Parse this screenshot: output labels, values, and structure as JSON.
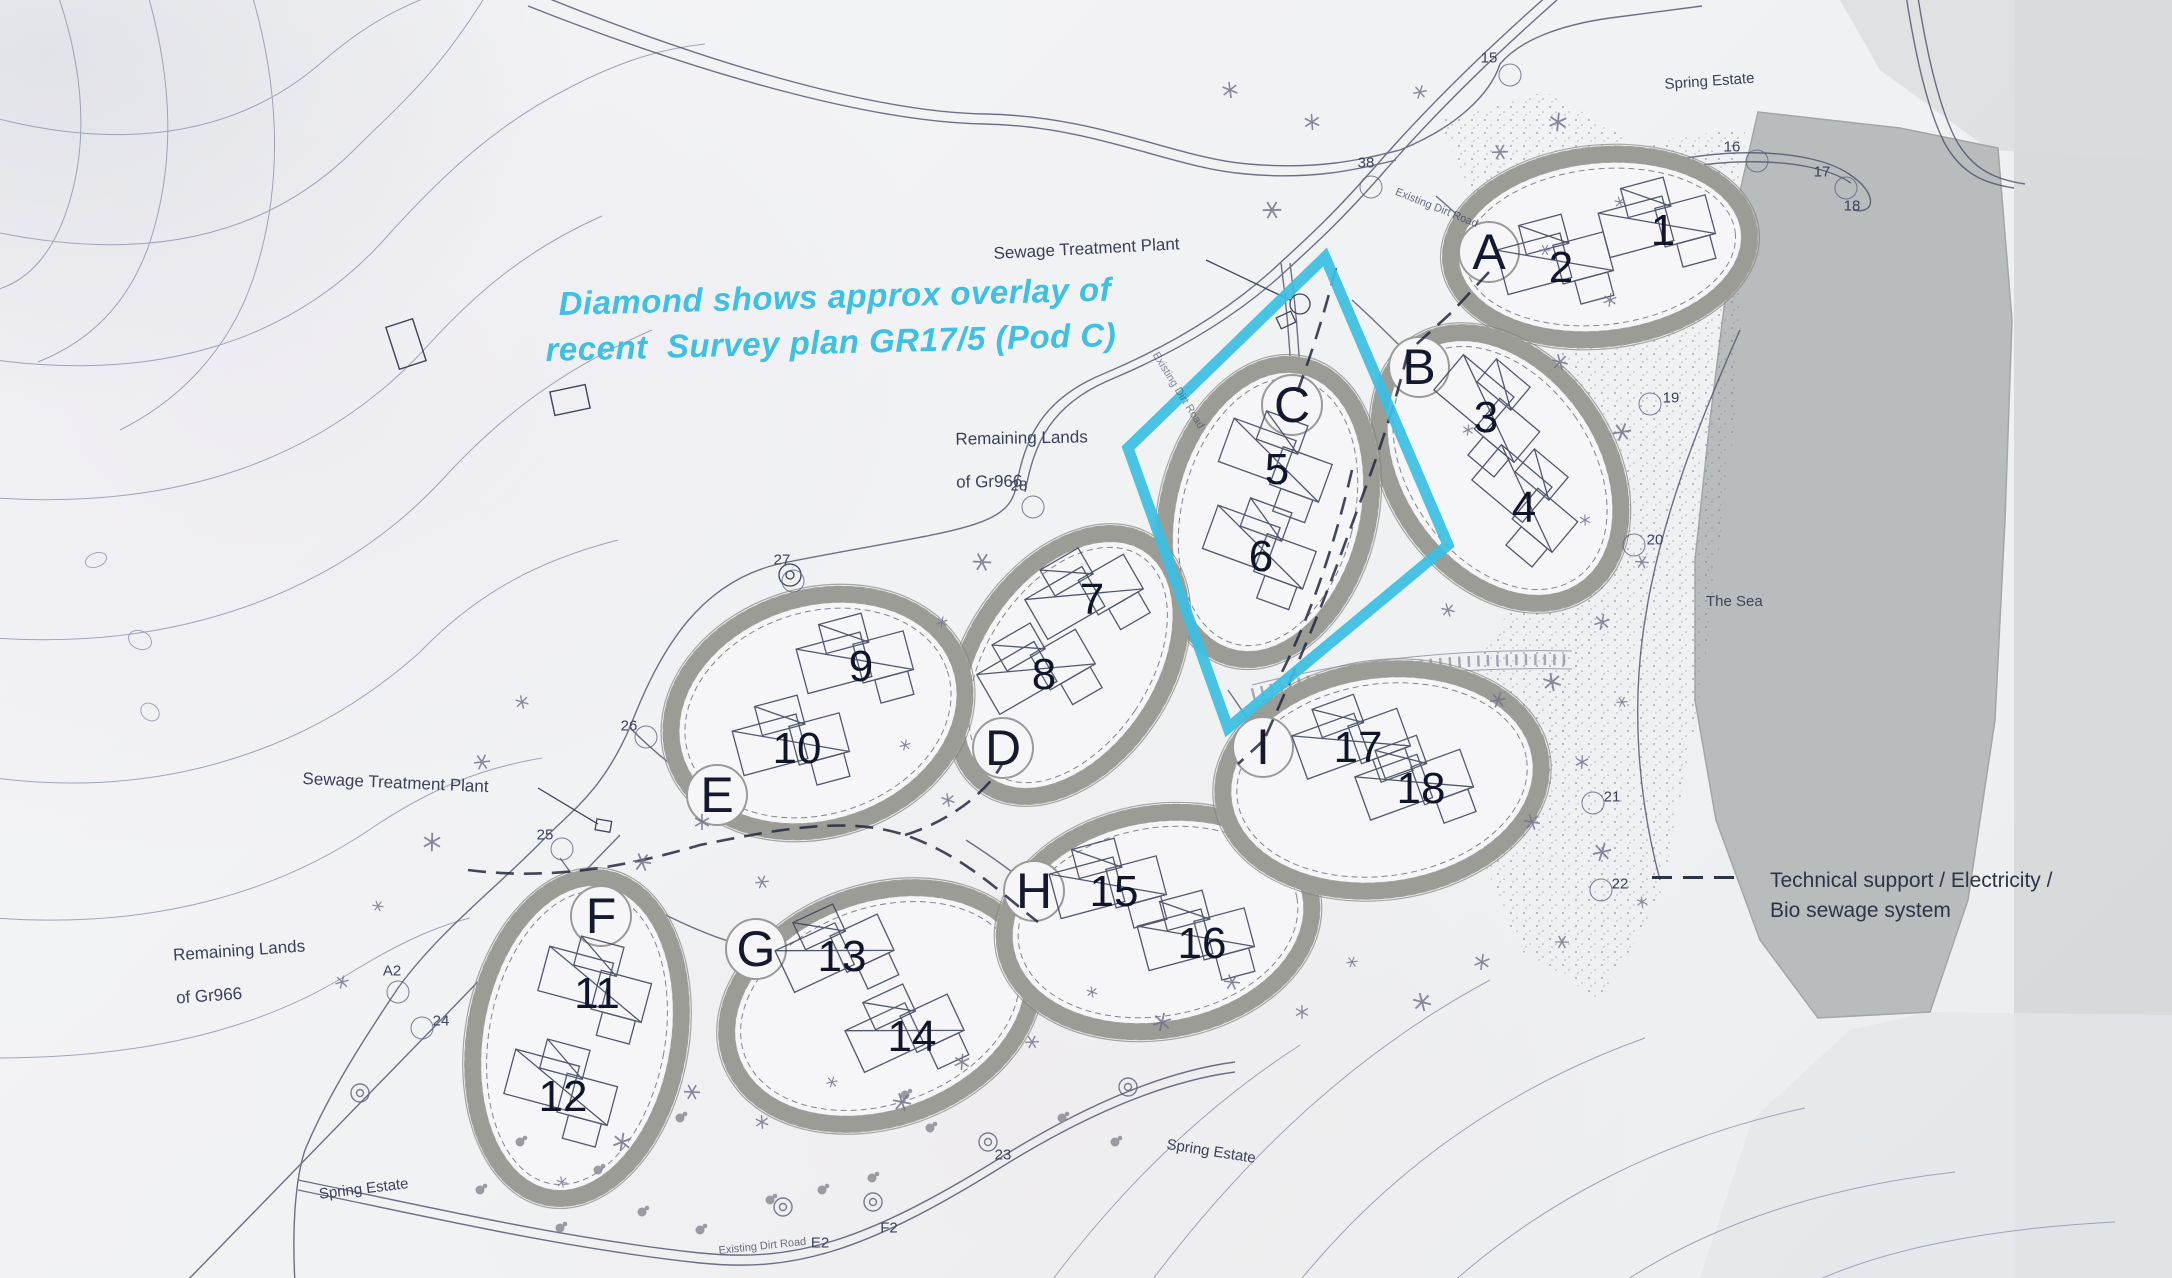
{
  "annotation": {
    "line1": "Diamond shows approx overlay of",
    "line2": "recent  Survey plan GR17/5 (Pod C)"
  },
  "legend": {
    "line1": "Technical support / Electricity /",
    "line2": "Bio sewage system"
  },
  "labels": {
    "sewage_plant": "Sewage Treatment Plant",
    "remaining_line1": "Remaining Lands",
    "remaining_line2": "of Gr966",
    "spring_estate": "Spring Estate",
    "the_sea": "The Sea",
    "existing_road": "Existing Dirt Road"
  },
  "colors": {
    "paper": "#f1f2f4",
    "ink": "#3d4359",
    "contour": "#9097ae",
    "ring_fill": "#aeaeaa",
    "ring_edge": "#83837f",
    "pod_interior": "#f6f6f8",
    "sea": "#b9bcbd",
    "photo_edge": "#d5d7d8",
    "stipple": "#6e7282",
    "star": "#73738c",
    "dash_line": "#23283e",
    "cyan_diamond": "#39bfe2",
    "text": "#39405a"
  },
  "pods": [
    {
      "letter": "A",
      "lx": 1489,
      "ly": 252,
      "cx": 1600,
      "cy": 247,
      "rx": 150,
      "ry": 92,
      "rot": -6,
      "units": [
        {
          "n": "1",
          "x": 1663,
          "y": 231,
          "hr": -15
        },
        {
          "n": "2",
          "x": 1561,
          "y": 268,
          "hr": -15
        }
      ]
    },
    {
      "letter": "B",
      "lx": 1419,
      "ly": 367,
      "cx": 1500,
      "cy": 468,
      "rx": 105,
      "ry": 148,
      "rot": -35,
      "units": [
        {
          "n": "3",
          "x": 1486,
          "y": 418,
          "hr": 40
        },
        {
          "n": "4",
          "x": 1524,
          "y": 508,
          "hr": 40
        }
      ]
    },
    {
      "letter": "C",
      "lx": 1292,
      "ly": 405,
      "cx": 1268,
      "cy": 512,
      "rx": 100,
      "ry": 150,
      "rot": 14,
      "units": [
        {
          "n": "5",
          "x": 1277,
          "y": 470,
          "hr": 20
        },
        {
          "n": "6",
          "x": 1261,
          "y": 557,
          "hr": 20
        }
      ]
    },
    {
      "letter": "D",
      "lx": 1003,
      "ly": 748,
      "cx": 1068,
      "cy": 665,
      "rx": 95,
      "ry": 145,
      "rot": 34,
      "units": [
        {
          "n": "7",
          "x": 1092,
          "y": 600,
          "hr": -30
        },
        {
          "n": "8",
          "x": 1044,
          "y": 675,
          "hr": -30
        }
      ]
    },
    {
      "letter": "E",
      "lx": 717,
      "ly": 795,
      "cx": 818,
      "cy": 713,
      "rx": 150,
      "ry": 115,
      "rot": -18,
      "units": [
        {
          "n": "9",
          "x": 861,
          "y": 667,
          "hr": -15
        },
        {
          "n": "10",
          "x": 797,
          "y": 749,
          "hr": -15
        }
      ]
    },
    {
      "letter": "F",
      "lx": 601,
      "ly": 916,
      "cx": 577,
      "cy": 1038,
      "rx": 102,
      "ry": 162,
      "rot": 10,
      "units": [
        {
          "n": "11",
          "x": 597,
          "y": 994,
          "hr": 15
        },
        {
          "n": "12",
          "x": 563,
          "y": 1097,
          "hr": 15
        }
      ]
    },
    {
      "letter": "G",
      "lx": 756,
      "ly": 949,
      "cx": 880,
      "cy": 1006,
      "rx": 158,
      "ry": 112,
      "rot": -20,
      "units": [
        {
          "n": "13",
          "x": 842,
          "y": 957,
          "hr": -25
        },
        {
          "n": "14",
          "x": 912,
          "y": 1037,
          "hr": -25
        }
      ]
    },
    {
      "letter": "H",
      "lx": 1034,
      "ly": 891,
      "cx": 1158,
      "cy": 922,
      "rx": 155,
      "ry": 108,
      "rot": -10,
      "units": [
        {
          "n": "15",
          "x": 1114,
          "y": 892,
          "hr": -15
        },
        {
          "n": "16",
          "x": 1202,
          "y": 944,
          "hr": -15
        }
      ]
    },
    {
      "letter": "I",
      "lx": 1263,
      "ly": 747,
      "cx": 1382,
      "cy": 780,
      "rx": 160,
      "ry": 110,
      "rot": -8,
      "units": [
        {
          "n": "17",
          "x": 1358,
          "y": 748,
          "hr": -20
        },
        {
          "n": "18",
          "x": 1421,
          "y": 789,
          "hr": -20
        }
      ]
    }
  ],
  "markers": [
    {
      "t": "15",
      "x": 1489,
      "y": 58,
      "c": [
        1510,
        75
      ]
    },
    {
      "t": "16",
      "x": 1732,
      "y": 147,
      "c": [
        1757,
        161
      ]
    },
    {
      "t": "17",
      "x": 1822,
      "y": 172,
      "c": [
        1846,
        188
      ]
    },
    {
      "t": "18",
      "x": 1852,
      "y": 206,
      "c": null
    },
    {
      "t": "38",
      "x": 1366,
      "y": 163,
      "c": [
        1371,
        187
      ]
    },
    {
      "t": "19",
      "x": 1671,
      "y": 398,
      "c": [
        1650,
        404
      ]
    },
    {
      "t": "20",
      "x": 1655,
      "y": 540,
      "c": [
        1634,
        545
      ]
    },
    {
      "t": "21",
      "x": 1612,
      "y": 797,
      "c": [
        1593,
        803
      ]
    },
    {
      "t": "22",
      "x": 1620,
      "y": 884,
      "c": [
        1601,
        890
      ]
    },
    {
      "t": "23",
      "x": 1003,
      "y": 1155,
      "c": null
    },
    {
      "t": "24",
      "x": 441,
      "y": 1021,
      "c": [
        422,
        1028
      ]
    },
    {
      "t": "25",
      "x": 545,
      "y": 835,
      "c": [
        562,
        849
      ]
    },
    {
      "t": "26",
      "x": 629,
      "y": 726,
      "c": [
        646,
        737
      ]
    },
    {
      "t": "27",
      "x": 782,
      "y": 560,
      "c": [
        793,
        581
      ]
    },
    {
      "t": "28",
      "x": 1019,
      "y": 486,
      "c": [
        1033,
        507
      ]
    },
    {
      "t": "A2",
      "x": 392,
      "y": 971,
      "c": [
        398,
        992
      ]
    },
    {
      "t": "E2",
      "x": 820,
      "y": 1243,
      "c": null
    },
    {
      "t": "F2",
      "x": 889,
      "y": 1228,
      "c": null
    }
  ],
  "diamond": {
    "points": [
      [
        1325,
        257
      ],
      [
        1448,
        545
      ],
      [
        1228,
        728
      ],
      [
        1128,
        448
      ]
    ]
  }
}
